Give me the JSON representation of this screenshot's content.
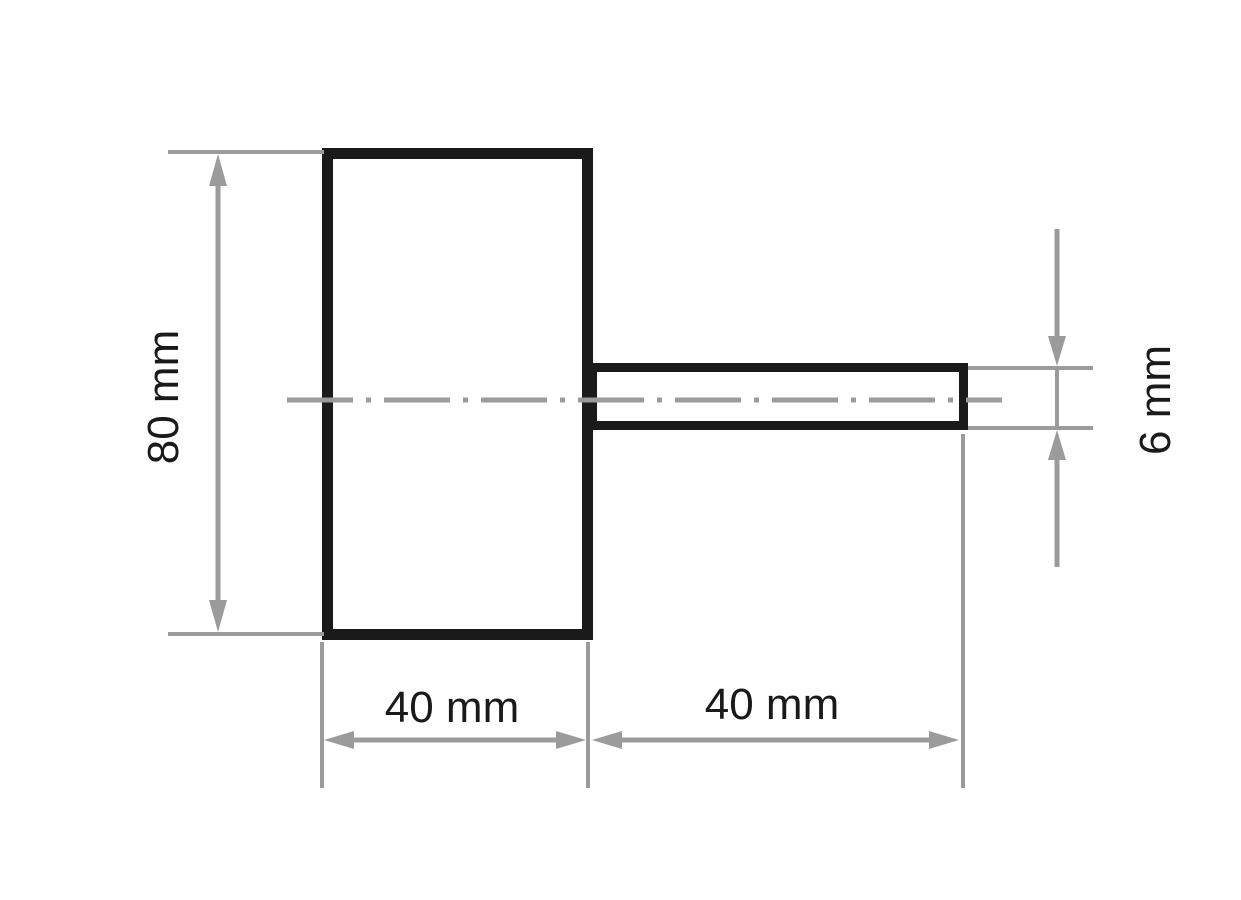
{
  "drawing": {
    "kind": "technical-dimension-drawing",
    "dimensions": {
      "body_height": {
        "label": "80 mm"
      },
      "body_width": {
        "label": "40 mm"
      },
      "shank_length": {
        "label": "40 mm"
      },
      "shank_diameter": {
        "label": "6 mm"
      }
    }
  },
  "colors": {
    "outline_black": "#1a1a1a",
    "dimension_gray": "#9b9b9b",
    "text_black": "#1a1a1a",
    "background": "#ffffff"
  }
}
